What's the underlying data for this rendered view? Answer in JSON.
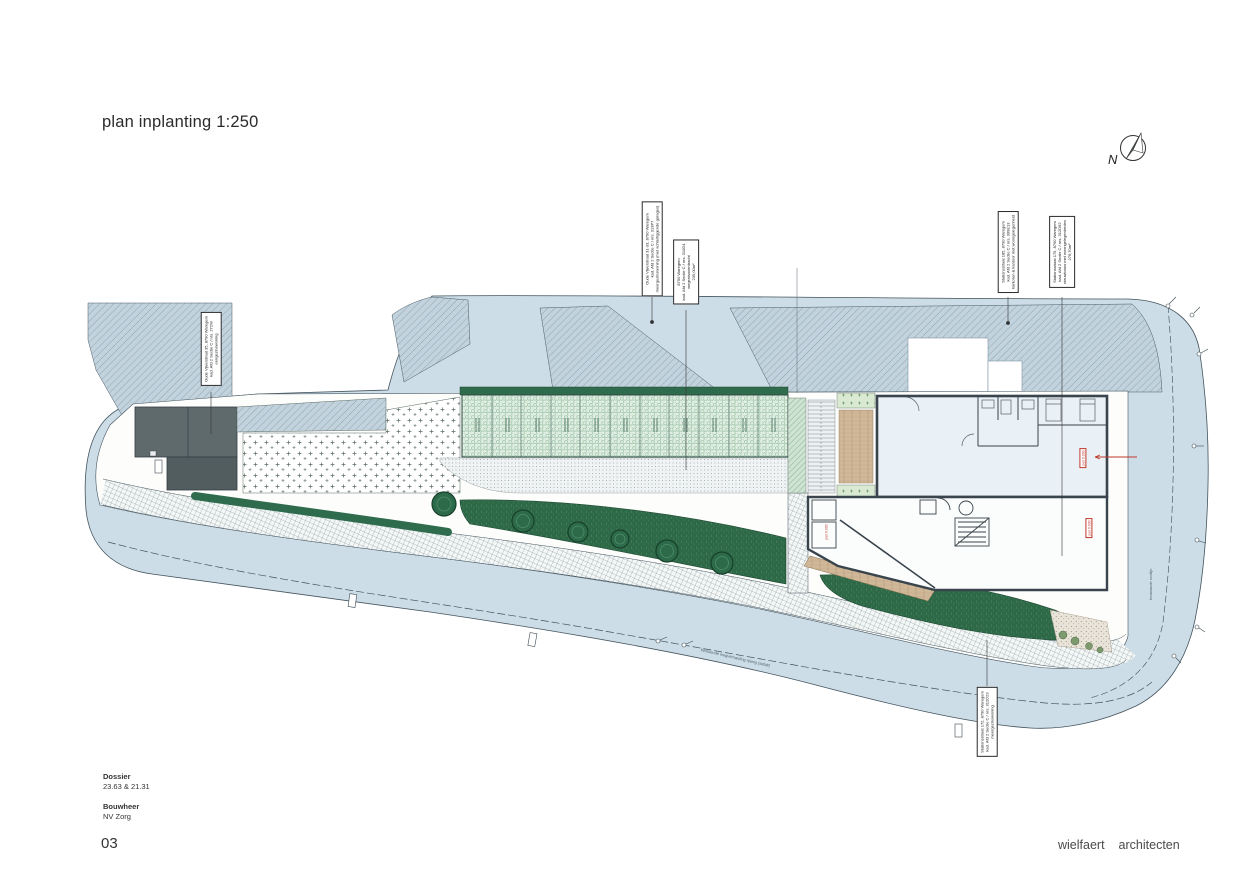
{
  "title": "plan inplanting 1:250",
  "north_label": "N",
  "annotations": [
    {
      "lines": [
        "Oude Vijverstraat 35, 8790 Waregem",
        "kad. Afd 2 Sectie C / nrs. 272W",
        "eengezinswoning"
      ]
    },
    {
      "lines": [
        "Oude Vijverstraat 31-33, 8790 Waregem",
        "kad. Afd 2 Sectie C / nrs. 313P7",
        "meergezinswoning (met achterliggende garages)"
      ]
    },
    {
      "lines": [
        "8790 Waregem",
        "kad. Afd 2 Sectie C / nrs. 310D4",
        "wegenisoverdracht",
        "235,00m²"
      ]
    },
    {
      "lines": [
        "Stationsstraat 185, 8790 Waregem",
        "kad. Afd 2 Sectie C / nrs. 309E13",
        "kantoren & kantoor met woongelegenheid"
      ]
    },
    {
      "lines": [
        "Stationsstraat 175, 8790 Waregem",
        "kad. Afd 2 Sectie C / nrs. 312D62",
        "nieuwbouw met woongelegenheden",
        "276,70m²"
      ]
    },
    {
      "lines": [
        "Stationsstraat 172, 8790 Waregem",
        "kad. Afd 2 Sectie C / nrs. 312D23",
        "meergezinswoning"
      ]
    }
  ],
  "stamps": [
    "peil 9.000",
    "peil 9.000",
    "peil 9.000"
  ],
  "road_label": "bestaande wegverharding rijweg (asfalt)",
  "rooilijn_label": "bestaande rooilijn",
  "footer": {
    "dossier_label": "Dossier",
    "dossier_value": "23.63 & 21.31",
    "bouwheer_label": "Bouwheer",
    "bouwheer_value": "NV Zorg",
    "page_number": "03",
    "firm_word1": "wielfaert",
    "firm_word2": "architecten"
  },
  "colors": {
    "road": "#cdddE8",
    "hatch_bg": "#c2d3de",
    "hedge_green": "#2f6b4d",
    "garage_green": "#e3efe5",
    "stamp_red": "#c0392b",
    "wall": "#39444c"
  }
}
